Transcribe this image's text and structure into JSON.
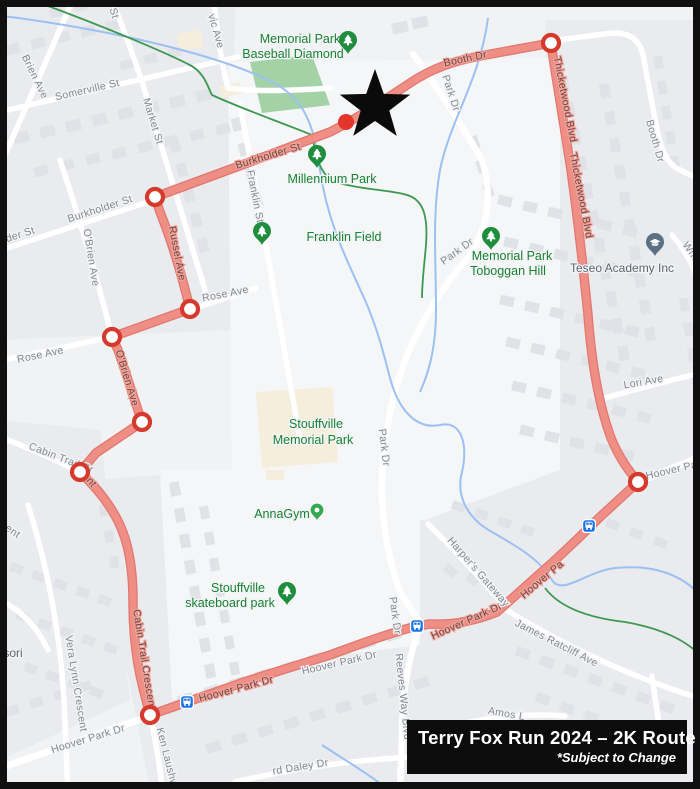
{
  "legend": {
    "title": "Terry Fox Run 2024 – 2K Route",
    "subtitle": "*Subject to Change"
  },
  "colors": {
    "route": "#ee8e85",
    "route_edge": "#e2776e",
    "waypoint_ring": "#d63a2c",
    "start_dot": "#e4352b",
    "star": "#0b0b0b",
    "park_text": "#188038",
    "street_text": "#84888f",
    "creek": "#9cc0f2",
    "trail": "#3d9850",
    "bus": "#1a73e8",
    "legend_bg": "#0c0c0c"
  },
  "map": {
    "route": {
      "name": "terry-fox-2k-route",
      "path": "M 155,197 L 250,162 L 330,132 C 370,112 395,92 418,78 C 440,65 460,60 480,56 L 551,43 C 557,85 565,130 571,170 C 578,220 583,265 588,315 C 591,355 597,400 611,438 C 620,460 630,472 638,482 L 600,517 C 580,537 566,550 553,562 L 497,612 C 475,621 452,625 430,624 L 417,626 C 390,633 360,644 330,655 L 250,680 L 150,715 L 143,688 C 136,660 133,632 133,602 C 133,566 128,541 118,521 C 108,501 95,486 80,472 L 96,453 L 142,422 C 133,396 124,367 118,350 L 112,337 L 190,309 C 181,272 170,237 160,212 L 155,197 Z",
      "waypoints": [
        [
          155,
          197
        ],
        [
          190,
          309
        ],
        [
          112,
          337
        ],
        [
          142,
          422
        ],
        [
          80,
          472
        ],
        [
          150,
          715
        ],
        [
          638,
          482
        ],
        [
          551,
          43
        ]
      ],
      "start": [
        346,
        122
      ],
      "star": [
        375,
        106
      ]
    },
    "bus_stops": [
      [
        187,
        702
      ],
      [
        417,
        626
      ],
      [
        589,
        526
      ]
    ],
    "pois": [
      {
        "type": "tree",
        "name": "memorial-park-baseball-pin",
        "x": 348,
        "y": 54
      },
      {
        "type": "tree",
        "name": "millennium-park-pin",
        "x": 317,
        "y": 168
      },
      {
        "type": "tree",
        "name": "franklin-field-pin",
        "x": 262,
        "y": 245
      },
      {
        "type": "tree",
        "name": "toboggan-hill-pin",
        "x": 491,
        "y": 250
      },
      {
        "type": "tree",
        "name": "skateboard-park-pin",
        "x": 287,
        "y": 605
      },
      {
        "type": "dot",
        "name": "annagym-pin",
        "x": 317,
        "y": 520
      },
      {
        "type": "school",
        "name": "teseo-academy-pin",
        "x": 655,
        "y": 256
      }
    ],
    "labels": [
      {
        "text": "St",
        "x": 111,
        "y": 14,
        "rot": 75,
        "cls": "street"
      },
      {
        "text": "Brien Ave",
        "x": 32,
        "y": 78,
        "rot": 64,
        "cls": "street"
      },
      {
        "text": "Somerville St",
        "x": 88,
        "y": 93,
        "rot": -13,
        "cls": "street"
      },
      {
        "text": "Market St",
        "x": 150,
        "y": 122,
        "rot": 73,
        "cls": "street"
      },
      {
        "text": "vic Ave",
        "x": 213,
        "y": 32,
        "rot": 74,
        "cls": "street"
      },
      {
        "text": "Memorial Park",
        "x": 300,
        "y": 43,
        "rot": 0,
        "cls": "park"
      },
      {
        "text": "Baseball Diamond",
        "x": 293,
        "y": 58,
        "rot": 0,
        "cls": "park"
      },
      {
        "text": "Booth Dr",
        "x": 466,
        "y": 62,
        "rot": -12,
        "cls": "route"
      },
      {
        "text": "Park Dr",
        "x": 448,
        "y": 94,
        "rot": 72,
        "cls": "street"
      },
      {
        "text": "Thicketwood Blvd",
        "x": 562,
        "y": 100,
        "rot": 79,
        "cls": "route"
      },
      {
        "text": "Thicketwood Blvd",
        "x": 578,
        "y": 196,
        "rot": 79,
        "cls": "route"
      },
      {
        "text": "Booth Dr",
        "x": 652,
        "y": 142,
        "rot": 74,
        "cls": "street"
      },
      {
        "text": "Burkholder St",
        "x": 269,
        "y": 159,
        "rot": -17,
        "cls": "route"
      },
      {
        "text": "Burkholder St",
        "x": 101,
        "y": 212,
        "rot": -18,
        "cls": "street"
      },
      {
        "text": "lder St",
        "x": 20,
        "y": 238,
        "rot": -18,
        "cls": "street"
      },
      {
        "text": "Franklin St",
        "x": 252,
        "y": 197,
        "rot": 79,
        "cls": "street"
      },
      {
        "text": "Millennium Park",
        "x": 332,
        "y": 183,
        "rot": 0,
        "cls": "park"
      },
      {
        "text": "Franklin Field",
        "x": 344,
        "y": 241,
        "rot": 0,
        "cls": "park"
      },
      {
        "text": "Park Dr",
        "x": 459,
        "y": 254,
        "rot": -36,
        "cls": "street"
      },
      {
        "text": "Memorial Park",
        "x": 512,
        "y": 260,
        "rot": 0,
        "cls": "park"
      },
      {
        "text": "Toboggan Hill",
        "x": 508,
        "y": 275,
        "rot": 0,
        "cls": "park"
      },
      {
        "text": "Teseo Academy Inc",
        "x": 622,
        "y": 272,
        "rot": 0,
        "cls": "poi"
      },
      {
        "text": "Wheele",
        "x": 693,
        "y": 260,
        "rot": 55,
        "cls": "street"
      },
      {
        "text": "Russel Ave",
        "x": 174,
        "y": 254,
        "rot": 79,
        "cls": "route"
      },
      {
        "text": "O'Brien Ave",
        "x": 88,
        "y": 258,
        "rot": 81,
        "cls": "street"
      },
      {
        "text": "Rose Ave",
        "x": 226,
        "y": 297,
        "rot": -11,
        "cls": "street"
      },
      {
        "text": "Rose Ave",
        "x": 41,
        "y": 358,
        "rot": -12,
        "cls": "street"
      },
      {
        "text": "O'Brien Ave",
        "x": 124,
        "y": 379,
        "rot": 73,
        "cls": "route"
      },
      {
        "text": "Lori Ave",
        "x": 644,
        "y": 385,
        "rot": -10,
        "cls": "street"
      },
      {
        "text": "Stouffville",
        "x": 316,
        "y": 428,
        "rot": 0,
        "cls": "park"
      },
      {
        "text": "Memorial Park",
        "x": 313,
        "y": 444,
        "rot": 0,
        "cls": "park"
      },
      {
        "text": "Park Dr",
        "x": 381,
        "y": 448,
        "rot": 83,
        "cls": "street"
      },
      {
        "text": "Cabin Trail Cr",
        "x": 60,
        "y": 461,
        "rot": 21,
        "cls": "street"
      },
      {
        "text": "ent",
        "x": 87,
        "y": 482,
        "rot": 50,
        "cls": "route"
      },
      {
        "text": "ent",
        "x": 11,
        "y": 534,
        "rot": 35,
        "cls": "street"
      },
      {
        "text": "AnnaGym",
        "x": 282,
        "y": 518,
        "rot": 0,
        "cls": "park"
      },
      {
        "text": "Stouffville",
        "x": 238,
        "y": 592,
        "rot": 0,
        "cls": "park"
      },
      {
        "text": "skateboard park",
        "x": 230,
        "y": 607,
        "rot": 0,
        "cls": "park"
      },
      {
        "text": "Cabin Trail Crescent",
        "x": 141,
        "y": 660,
        "rot": 81,
        "cls": "route"
      },
      {
        "text": "Vera Lynn Crescent",
        "x": 73,
        "y": 684,
        "rot": 81,
        "cls": "street"
      },
      {
        "text": "sori",
        "x": 13,
        "y": 657,
        "rot": 0,
        "cls": "poi"
      },
      {
        "text": "Hoover Park Dr",
        "x": 237,
        "y": 692,
        "rot": -15,
        "cls": "route"
      },
      {
        "text": "Hoover Park Dr",
        "x": 89,
        "y": 742,
        "rot": -17,
        "cls": "street"
      },
      {
        "text": "Hoover Park Dr",
        "x": 340,
        "y": 666,
        "rot": -13,
        "cls": "street"
      },
      {
        "text": "Hoover Park Dr",
        "x": 468,
        "y": 624,
        "rot": -24,
        "cls": "route"
      },
      {
        "text": "Hoover Pa",
        "x": 544,
        "y": 582,
        "rot": -40,
        "cls": "route"
      },
      {
        "text": "Hoover Par",
        "x": 674,
        "y": 473,
        "rot": -13,
        "cls": "street"
      },
      {
        "text": "Harper's Gateway",
        "x": 476,
        "y": 574,
        "rot": 49,
        "cls": "street"
      },
      {
        "text": "Reeves Way Blvd",
        "x": 400,
        "y": 697,
        "rot": 84,
        "cls": "street"
      },
      {
        "text": "Park Dr",
        "x": 392,
        "y": 616,
        "rot": 82,
        "cls": "street"
      },
      {
        "text": "Ken Laushw",
        "x": 164,
        "y": 758,
        "rot": 76,
        "cls": "street"
      },
      {
        "text": "James Ratcliff Ave",
        "x": 555,
        "y": 646,
        "rot": 27,
        "cls": "street"
      },
      {
        "text": "rd Daley Dr",
        "x": 301,
        "y": 770,
        "rot": -9,
        "cls": "street"
      },
      {
        "text": "Amos L",
        "x": 506,
        "y": 717,
        "rot": 10,
        "cls": "street"
      }
    ]
  }
}
